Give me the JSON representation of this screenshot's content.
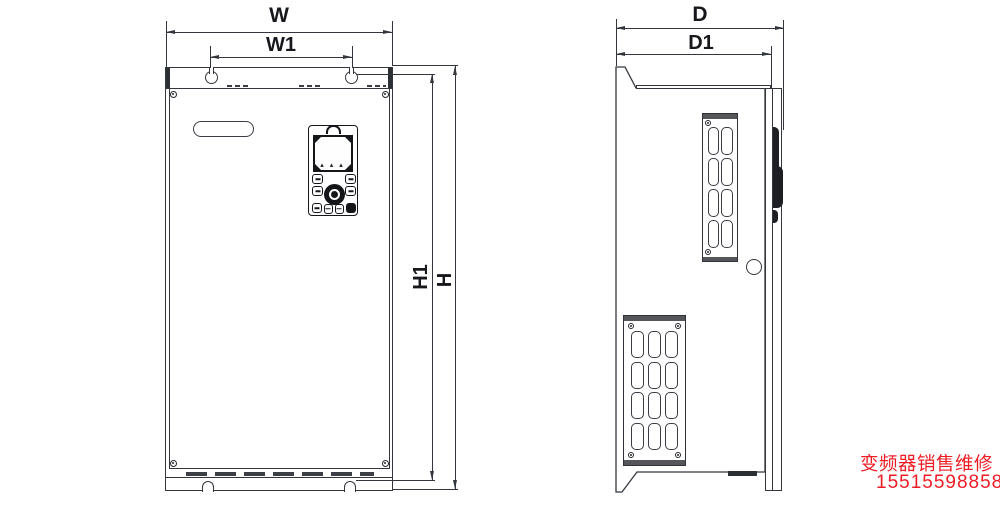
{
  "dimensions": {
    "W": "W",
    "W1": "W1",
    "H": "H",
    "H1": "H1",
    "D": "D",
    "D1": "D1"
  },
  "watermark": {
    "line1": "变频器销售维修",
    "line2": "15515598858",
    "color": "#ee1c25"
  },
  "icons": {
    "keypad_indicator_arrows": "▴ ▴ ▴"
  },
  "colors": {
    "line": "#33373d",
    "dark_fill": "#1d1f24",
    "grille_cap": "#54565a",
    "watermark_red": "#ee1c25"
  }
}
